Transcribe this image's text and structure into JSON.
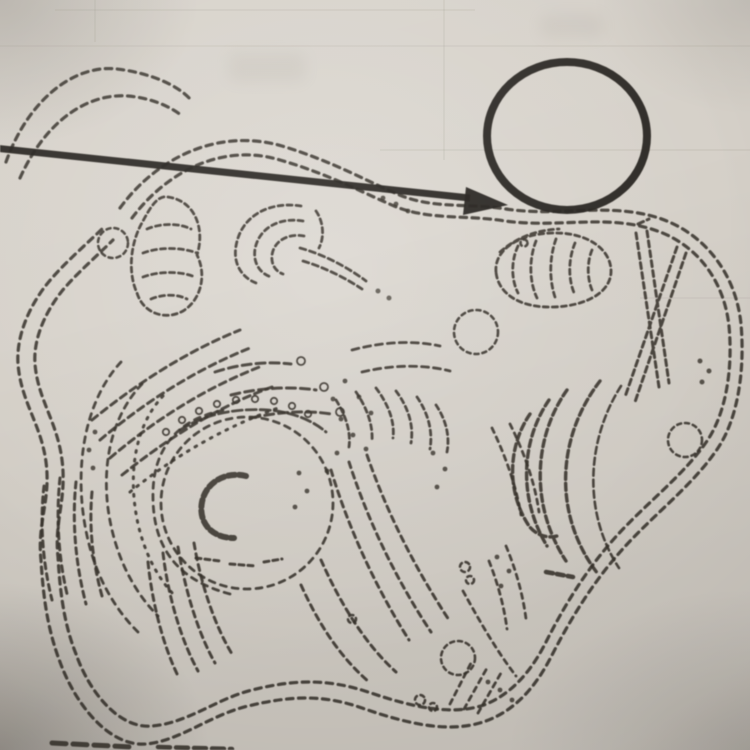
{
  "meta": {
    "kind": "photographed worksheet diagram",
    "subject": "animal cell line drawing (dotted electron-micrograph style)",
    "visible_text": ""
  },
  "colors": {
    "paper": "#d5d0c8",
    "paper_edge": "#a69f97",
    "ink": "#38332c",
    "bold_ink": "#272420",
    "ruled": "#8d857a"
  },
  "annotation": {
    "pointer": "bold arrow entering from left edge, pointing at the cell membrane",
    "answer_circle": "empty bold circle at top right used as label blank"
  },
  "diagram_parts": [
    "cell-membrane",
    "cytoplasm",
    "nucleus",
    "nuclear-envelope",
    "nucleolus",
    "rough-endoplasmic-reticulum",
    "smooth-endoplasmic-reticulum",
    "ribosomes",
    "golgi-apparatus",
    "mitochondria",
    "centrioles",
    "vacuoles",
    "vesicles"
  ]
}
